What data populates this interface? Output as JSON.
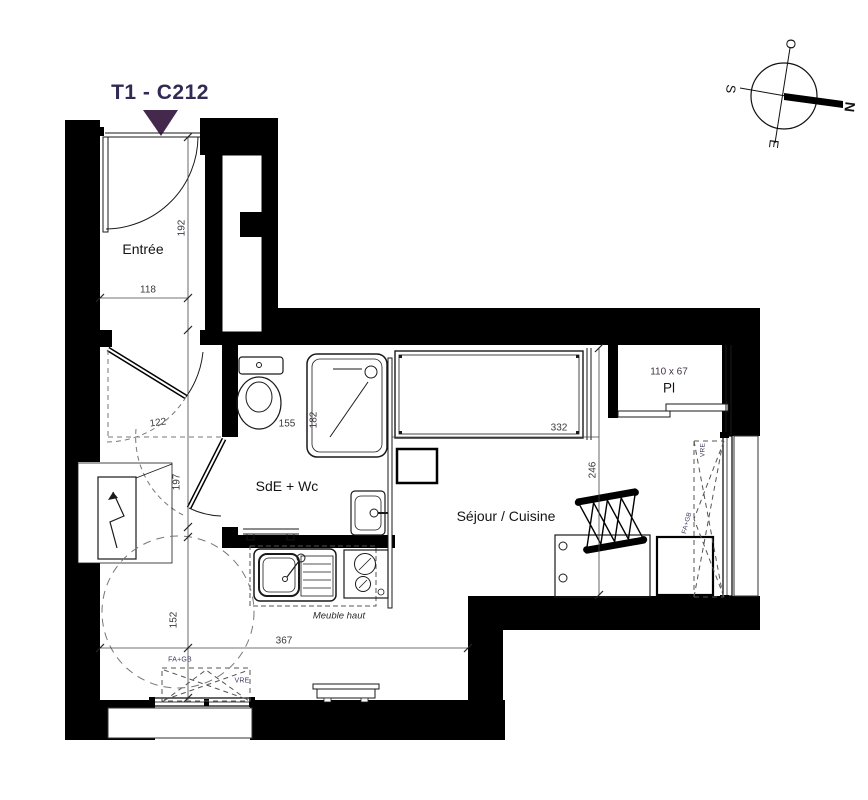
{
  "title": "T1 - C212",
  "rooms": {
    "entree": "Entrée",
    "bathroom": "SdE + Wc",
    "living": "Séjour / Cuisine",
    "closet": "Pl",
    "closet_size": "110 x 67"
  },
  "dims": {
    "entree_height": "192",
    "entree_width": "118",
    "hall_width": "122",
    "hall_height": "197",
    "bath_width": "155",
    "shower_width": "182",
    "bed_width": "332",
    "living_height": "246",
    "left_width": "152",
    "bottom_width": "367"
  },
  "annotations": {
    "upper_cabinet": "Meuble haut",
    "window_right_type": "FA+GB",
    "window_right_shutter": "VRE",
    "window_bottom_type": "FA+GB",
    "window_bottom_shutter": "VRE"
  },
  "compass": {
    "west": "O",
    "south": "S",
    "north": "N",
    "east": "E"
  },
  "colors": {
    "wall": "#000000",
    "title_text": "#322a54",
    "entry_marker": "#45294d",
    "line": "#1a1a1a",
    "dim_text": "#3e3640",
    "dashed": "#666666"
  }
}
